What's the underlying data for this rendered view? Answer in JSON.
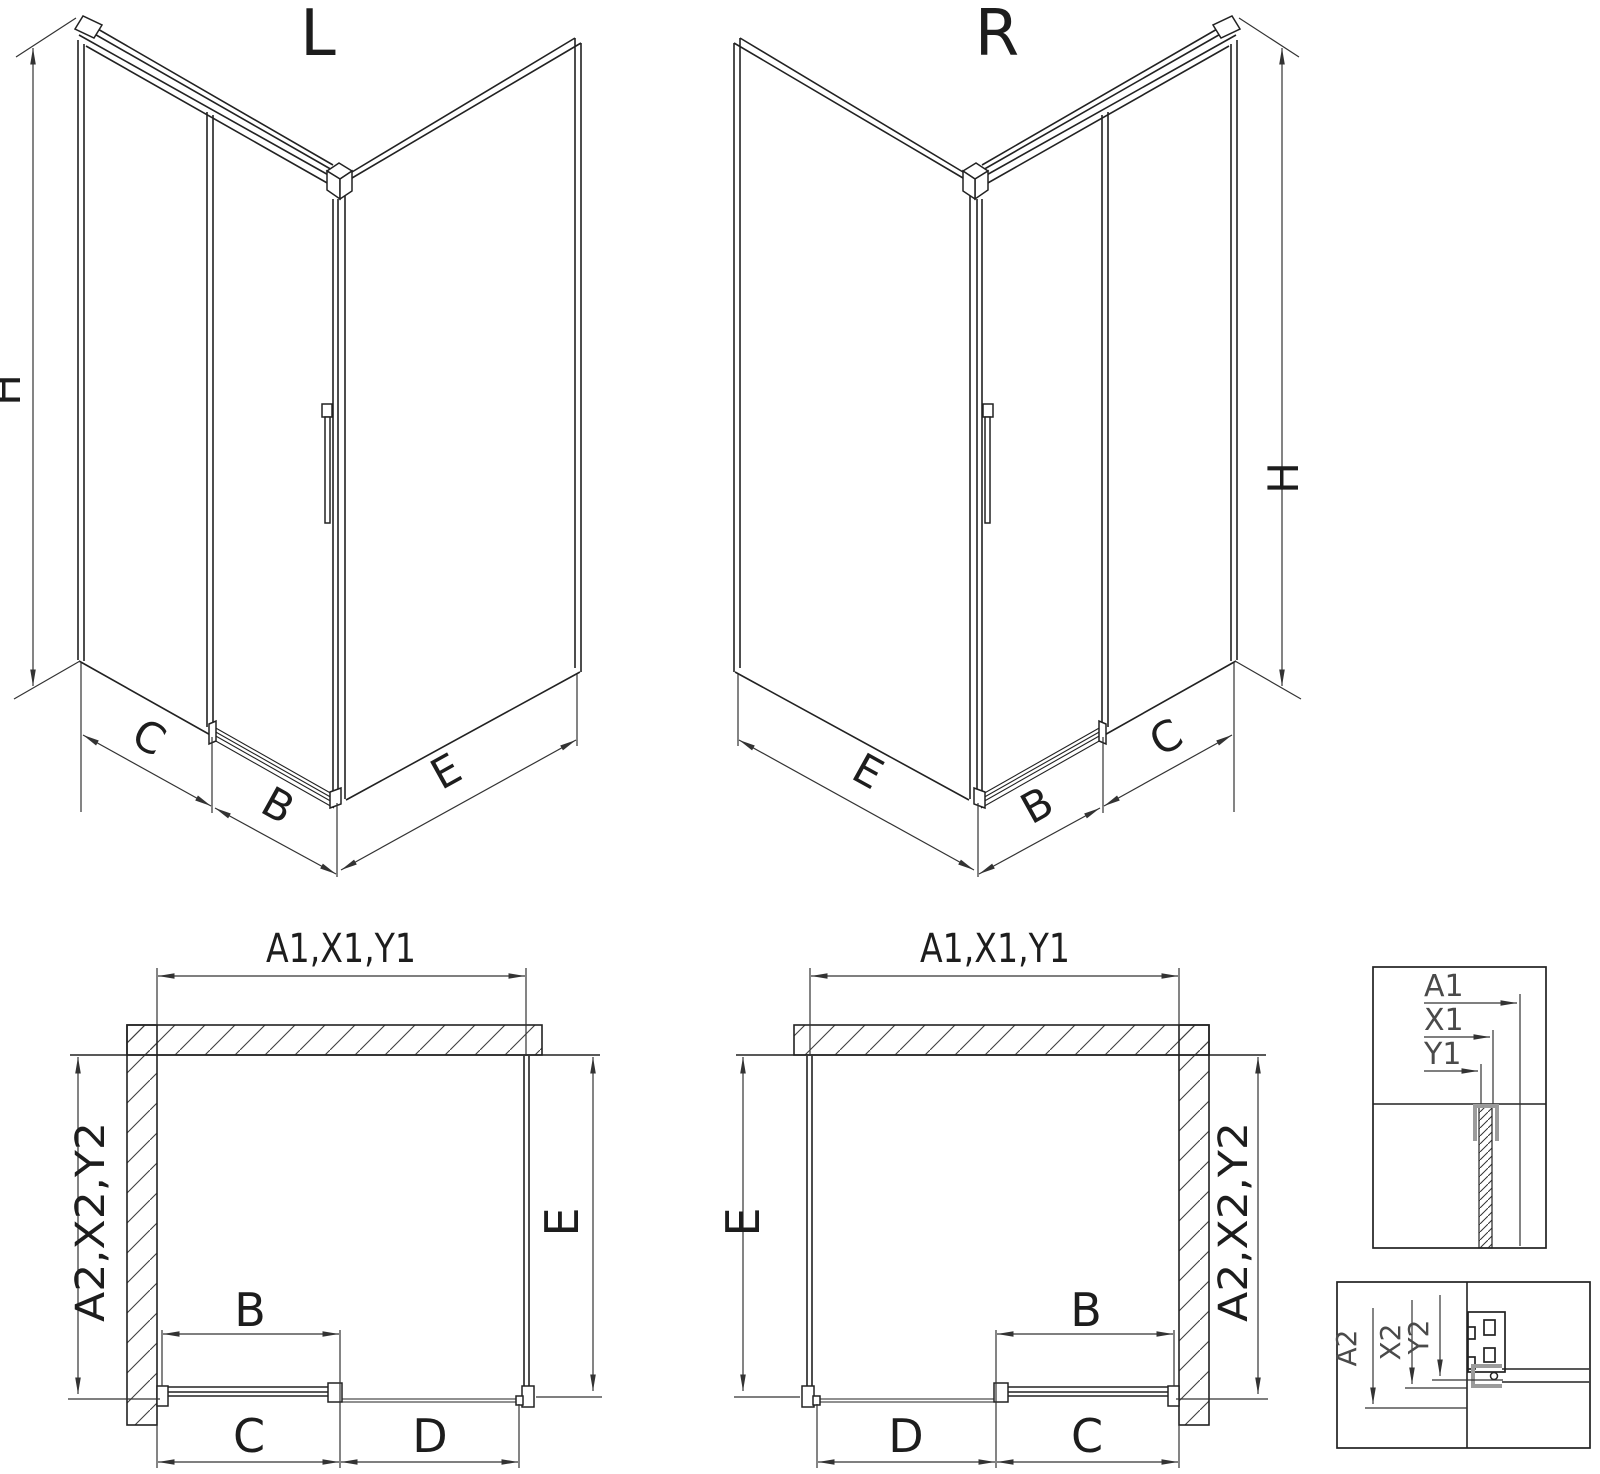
{
  "drawing": {
    "type": "shower-enclosure-installation-diagram",
    "background": "#ffffff"
  },
  "views": {
    "iso_left": {
      "title": "L",
      "dim_height": "H",
      "dim_panel": "C",
      "dim_door": "B",
      "dim_side": "E"
    },
    "iso_right": {
      "title": "R",
      "dim_height": "H",
      "dim_panel": "C",
      "dim_door": "B",
      "dim_side": "E"
    },
    "plan_left": {
      "dim_width_top": "A1,X1,Y1",
      "dim_depth_side": "A2,X2,Y2",
      "dim_door": "B",
      "dim_door_run": "C",
      "dim_fixed": "D",
      "dim_side": "E"
    },
    "plan_right": {
      "dim_width_top": "A1,X1,Y1",
      "dim_depth_side": "A2,X2,Y2",
      "dim_door": "B",
      "dim_door_run": "C",
      "dim_fixed": "D",
      "dim_side": "E"
    },
    "detail_width_refs": {
      "labels": [
        "A1",
        "X1",
        "Y1"
      ]
    },
    "detail_depth_refs": {
      "labels": [
        "A2",
        "X2",
        "Y2"
      ]
    }
  },
  "colors": {
    "line": "#222222",
    "dimension_line": "#333333",
    "label_text": "#1d1d1d",
    "detail_label_text": "#4a4a4a",
    "profile_highlight_gray": "#9b9b9b",
    "background": "#ffffff"
  }
}
